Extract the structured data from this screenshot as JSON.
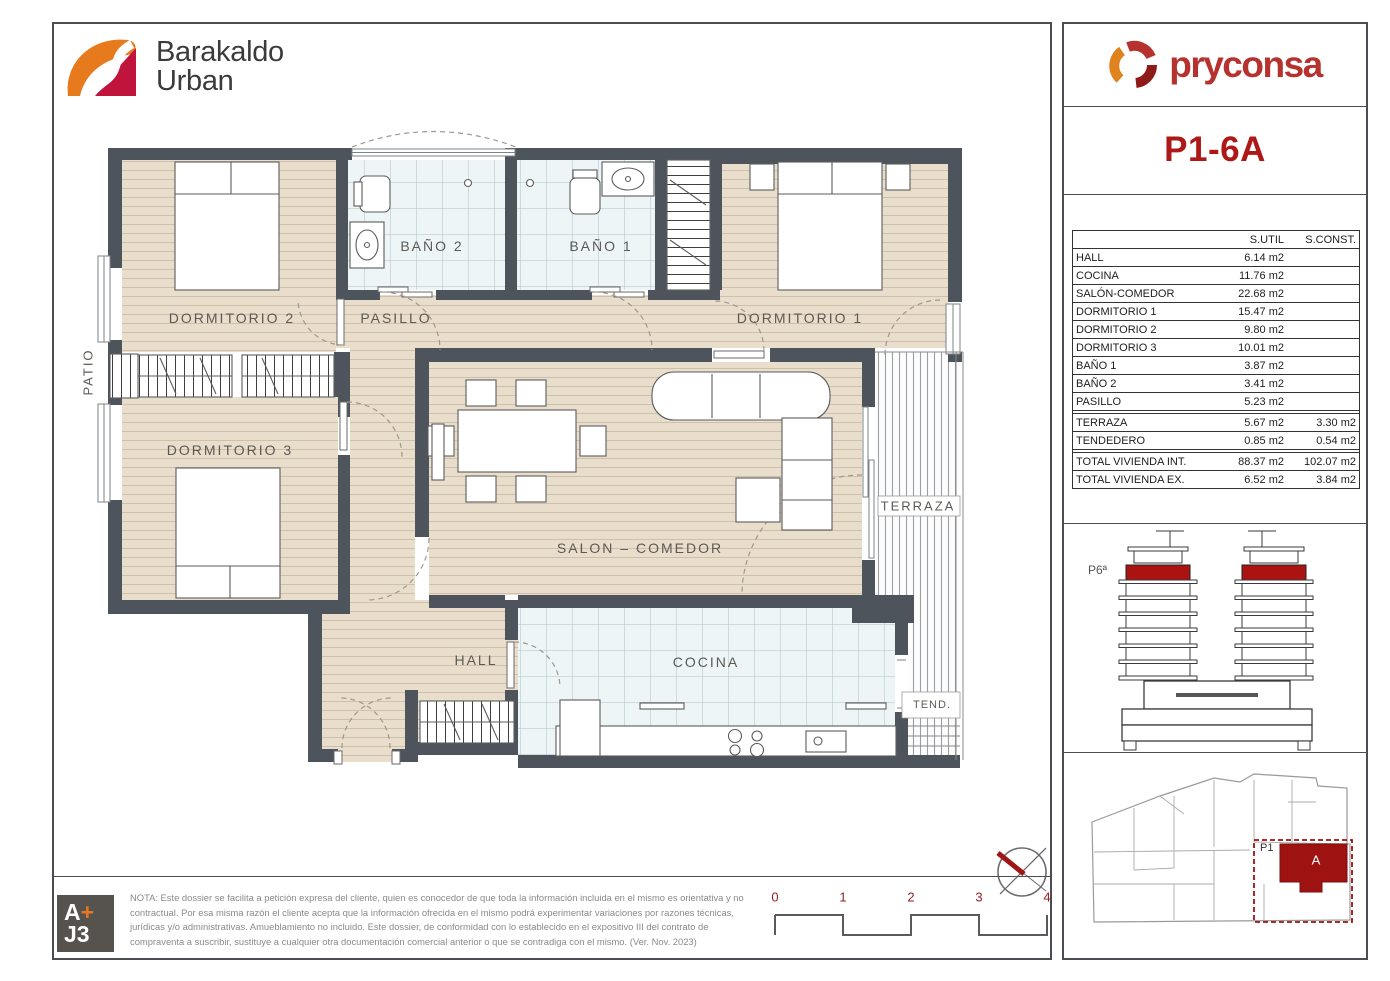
{
  "branding": {
    "project": {
      "line1": "Barakaldo",
      "line2": "Urban"
    },
    "developer": "pryconsa"
  },
  "unit_code": "P1-6A",
  "areas_table": {
    "col_util": "S.UTIL",
    "col_const": "S.CONST.",
    "interior_rows": [
      {
        "label": "HALL",
        "util": "6.14 m2"
      },
      {
        "label": "COCINA",
        "util": "11.76 m2"
      },
      {
        "label": "SALÓN-COMEDOR",
        "util": "22.68 m2"
      },
      {
        "label": "DORMITORIO 1",
        "util": "15.47 m2"
      },
      {
        "label": "DORMITORIO 2",
        "util": "9.80 m2"
      },
      {
        "label": "DORMITORIO 3",
        "util": "10.01 m2"
      },
      {
        "label": "BAÑO 1",
        "util": "3.87 m2"
      },
      {
        "label": "BAÑO 2",
        "util": "3.41 m2"
      },
      {
        "label": "PASILLO",
        "util": "5.23 m2"
      }
    ],
    "exterior_rows": [
      {
        "label": "TERRAZA",
        "util": "5.67 m2",
        "const": "3.30 m2"
      },
      {
        "label": "TENDEDERO",
        "util": "0.85 m2",
        "const": "0.54 m2"
      }
    ],
    "total_rows": [
      {
        "label": "TOTAL VIVIENDA INT.",
        "util": "88.37 m2",
        "const": "102.07 m2"
      },
      {
        "label": "TOTAL VIVIENDA EX.",
        "util": "6.52 m2",
        "const": "3.84 m2"
      }
    ]
  },
  "elevation": {
    "floor_label": "P6ª"
  },
  "site_plan": {
    "block_label": "P1",
    "unit_label": "A"
  },
  "plan_labels": {
    "dormitorio1": "DORMITORIO 1",
    "dormitorio2": "DORMITORIO 2",
    "dormitorio3": "DORMITORIO 3",
    "bano1": "BAÑO 1",
    "bano2": "BAÑO 2",
    "pasillo": "PASILLO",
    "salon": "SALON – COMEDOR",
    "hall": "HALL",
    "cocina": "COCINA",
    "terraza": "TERRAZA",
    "tendedero": "TEND.",
    "patio": "PATIO"
  },
  "scale_bar": {
    "ticks": [
      "0",
      "1",
      "2",
      "3",
      "4"
    ]
  },
  "architect_logo": {
    "a": "A",
    "plus": "+",
    "j3": "J3"
  },
  "legal_note": "NOTA: Este dossier se facilita a petición expresa del cliente, quien es conocedor de que toda la información incluida en el mismo es orientativa y no contractual. Por esa misma razón el cliente acepta que la información ofrecida en el mismo podrá experimentar variaciones por razones técnicas, jurídicas y/o administrativas. Amueblamiento no incluido. Este dossier, de conformidad con lo establecido en el expositivo III del contrato de compraventa a suscribir, sustituye a cualquier otra documentación comercial anterior o que se contradiga con el mismo. (Ver. Nov. 2023)",
  "colors": {
    "accent_red": "#ae1917",
    "unit_fill_red": "#9e1212",
    "wall_gray": "#4e545c",
    "logo_orange": "#e0821e",
    "logo_crimson": "#b5322e"
  }
}
